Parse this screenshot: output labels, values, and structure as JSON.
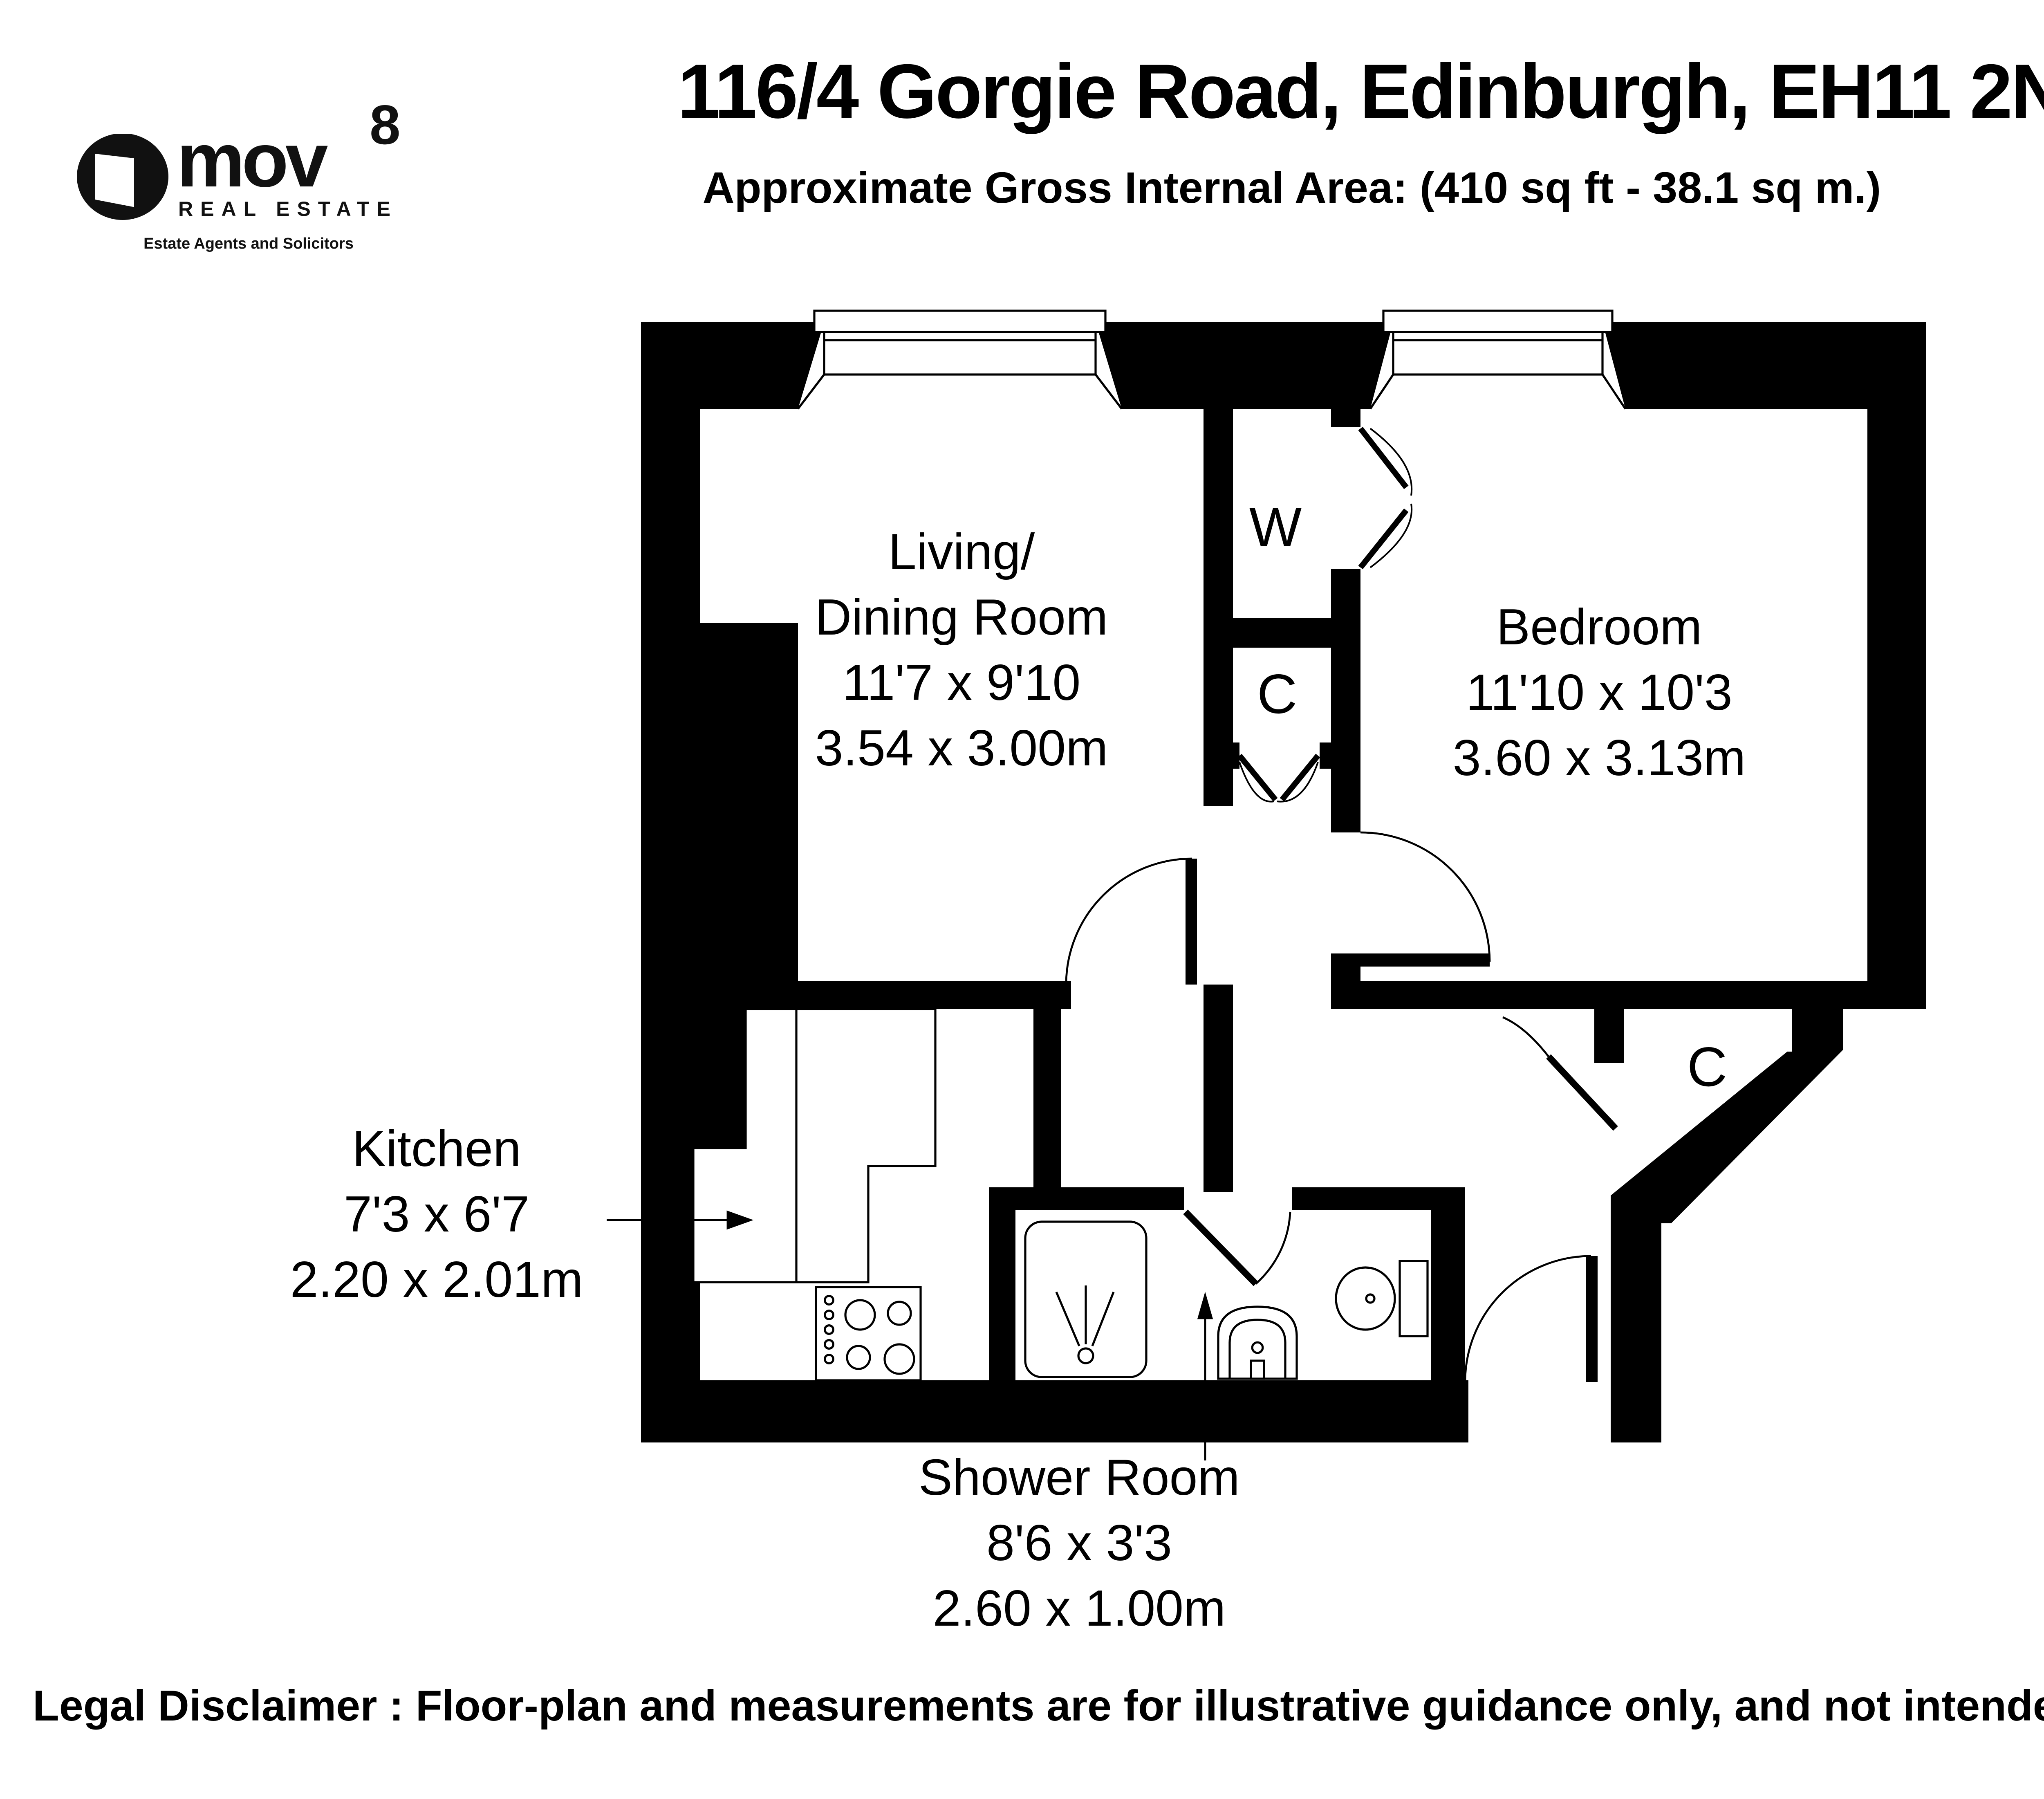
{
  "header": {
    "title": "116/4 Gorgie Road, Edinburgh, EH11 2NR",
    "subtitle": "Approximate Gross Internal Area: (410 sq ft - 38.1 sq m.)"
  },
  "logo": {
    "brand": "mov",
    "superscript": "8",
    "tagline": "REAL ESTATE",
    "subtagline": "Estate Agents and Solicitors"
  },
  "rooms": {
    "living": {
      "name_line1": "Living/",
      "name_line2": "Dining Room",
      "imperial": "11'7 x 9'10",
      "metric": "3.54 x 3.00m"
    },
    "bedroom": {
      "name": "Bedroom",
      "imperial": "11'10 x 10'3",
      "metric": "3.60 x 3.13m"
    },
    "kitchen": {
      "name": "Kitchen",
      "imperial": "7'3 x 6'7",
      "metric": "2.20 x 2.01m"
    },
    "shower": {
      "name": "Shower Room",
      "imperial": "8'6 x 3'3",
      "metric": "2.60 x 1.00m"
    },
    "wardrobe_label": "W",
    "cupboard_label": "C",
    "hall_cupboard_label": "C"
  },
  "compass": {
    "north_label": "N"
  },
  "footer": {
    "disclaimer": "Legal Disclaimer : Floor-plan and measurements are for illustrative guidance only, and not intended to form part of any contract."
  },
  "colors": {
    "wall": "#000000",
    "background": "#ffffff"
  }
}
